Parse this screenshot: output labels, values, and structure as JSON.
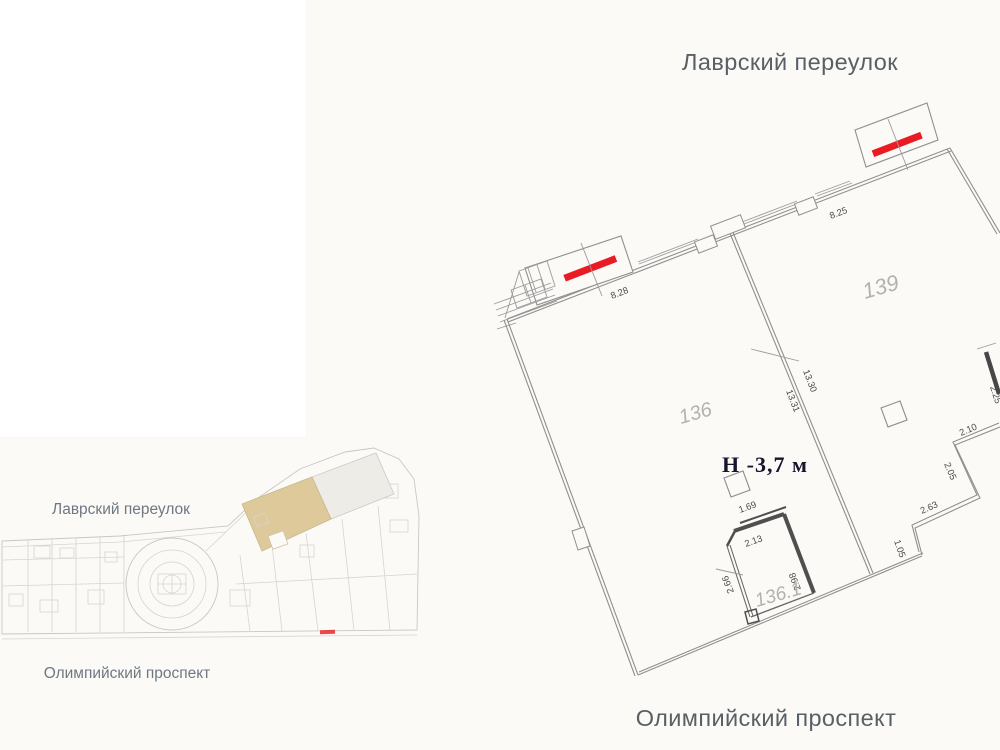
{
  "streets": {
    "top": "Лаврский переулок",
    "bottom": "Олимпийский проспект"
  },
  "minimap": {
    "street_top": "Лаврский переулок",
    "street_bottom": "Олимпийский проспект"
  },
  "plan": {
    "height_label": "Н -3,7 м",
    "rooms": {
      "r136": "136",
      "r139": "139",
      "r136_1": "136.1"
    },
    "dims": {
      "d828": "8.28",
      "d825": "8.25",
      "d1330": "13.30",
      "d1331": "13.31",
      "d225": "2.25",
      "d210": "2.10",
      "d205": "2.05",
      "d263": "2.63",
      "d105": "1.05",
      "d169": "1.69",
      "d213": "2.13",
      "d298": "2.98",
      "d266": "2.66"
    },
    "colors": {
      "entrance": "#ea1c23",
      "highlight": "#dcc794"
    }
  }
}
